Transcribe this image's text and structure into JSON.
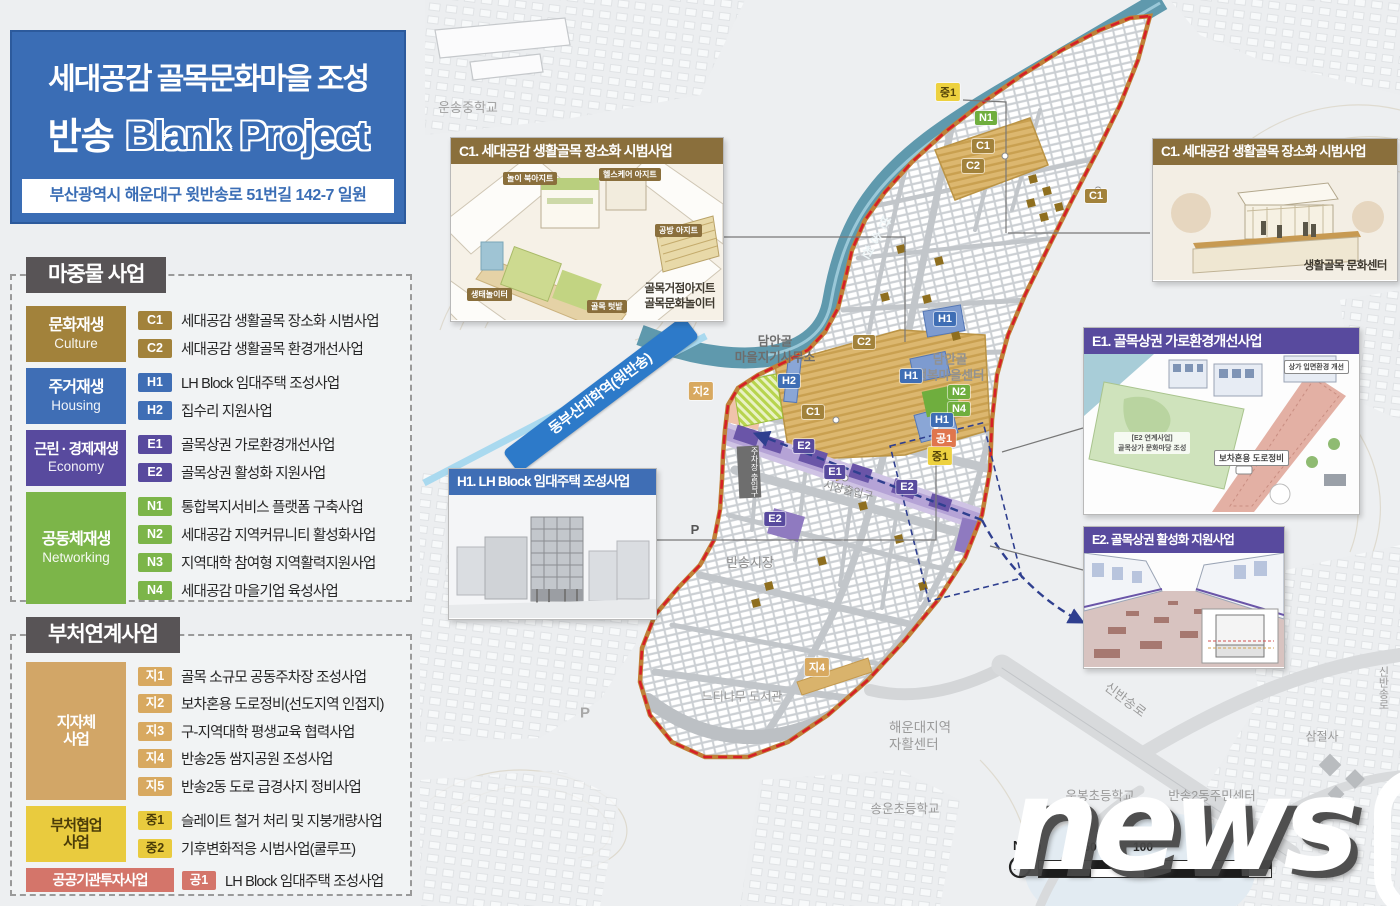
{
  "title_panel": {
    "line1": "세대공감 골목문화마을 조성",
    "line2_prefix": "반송",
    "line2_main": "Blank Project",
    "address": "부산광역시 해운대구 윗반송로 51번길 142-7 일원"
  },
  "legend_primary": {
    "header": "마중물 사업",
    "categories": [
      {
        "name": "문화재생",
        "en": "Culture",
        "color": "#a2823b",
        "items": [
          {
            "code": "C1",
            "label": "세대공감 생활골목 장소화 시범사업"
          },
          {
            "code": "C2",
            "label": "세대공감 생활골목 환경개선사업"
          }
        ]
      },
      {
        "name": "주거재생",
        "en": "Housing",
        "color": "#3f6eb5",
        "items": [
          {
            "code": "H1",
            "label": "LH Block 임대주택 조성사업"
          },
          {
            "code": "H2",
            "label": "집수리 지원사업"
          }
        ]
      },
      {
        "name": "근린 · 경제재생",
        "en": "Economy",
        "color": "#584a9e",
        "items": [
          {
            "code": "E1",
            "label": "골목상권 가로환경개선사업"
          },
          {
            "code": "E2",
            "label": "골목상권 활성화 지원사업"
          }
        ]
      },
      {
        "name": "공동체재생",
        "en": "Networking",
        "color": "#7cb549",
        "items": [
          {
            "code": "N1",
            "label": "통합복지서비스 플랫폼 구축사업"
          },
          {
            "code": "N2",
            "label": "세대공감 지역커뮤니티 활성화사업"
          },
          {
            "code": "N3",
            "label": "지역대학 참여형 지역활력지원사업"
          },
          {
            "code": "N4",
            "label": "세대공감 마을기업 육성사업"
          }
        ]
      }
    ]
  },
  "legend_secondary": {
    "header": "부처연계사업",
    "groups": [
      {
        "name": "지자체\n사업",
        "color": "#d2a667",
        "items": [
          {
            "code": "지1",
            "label": "골목 소규모 공동주차장 조성사업"
          },
          {
            "code": "지2",
            "label": "보차혼용 도로정비(선도지역 인접지)"
          },
          {
            "code": "지3",
            "label": "구-지역대학 평생교육 협력사업"
          },
          {
            "code": "지4",
            "label": "반송2동 쌈지공원 조성사업"
          },
          {
            "code": "지5",
            "label": "반송2동 도로 급경사지 정비사업"
          }
        ]
      },
      {
        "name": "부처협업\n사업",
        "color": "#e9cb3e",
        "items": [
          {
            "code": "중1",
            "label": "슬레이트 철거 처리 및 지붕개량사업"
          },
          {
            "code": "중2",
            "label": "기후변화적응 시범사업(쿨루프)"
          }
        ]
      },
      {
        "name": "공공기관투자사업",
        "color": "#d4756a",
        "items": [
          {
            "code": "공1",
            "label": "LH Block 임대주택 조성사업"
          }
        ]
      }
    ]
  },
  "map": {
    "station_banner": "동부산대학역(윗반송)",
    "labels": [
      {
        "text": "운송중학교"
      },
      {
        "text": "반송천"
      },
      {
        "text": "담안골\n마을지기사무소"
      },
      {
        "text": "담안골\n행복마을센터"
      },
      {
        "text": "주차장 출입구"
      },
      {
        "text": "시장출입구"
      },
      {
        "text": "반송시장"
      },
      {
        "text": "P"
      },
      {
        "text": "P"
      },
      {
        "text": "느티나무 도서관"
      },
      {
        "text": "해운대지역\n자활센터"
      },
      {
        "text": "송운초등학교"
      },
      {
        "text": "운봉초등학교"
      },
      {
        "text": "반송2동주민센터"
      },
      {
        "text": "신반송로"
      },
      {
        "text": "신반송로"
      },
      {
        "text": "삼절사"
      }
    ],
    "markers": [
      {
        "label": "중1"
      },
      {
        "label": "N1"
      },
      {
        "label": "C1"
      },
      {
        "label": "C2"
      },
      {
        "label": "C1"
      },
      {
        "label": "H1"
      },
      {
        "label": "C2"
      },
      {
        "label": "H1"
      },
      {
        "label": "H2"
      },
      {
        "label": "N2"
      },
      {
        "label": "N4"
      },
      {
        "label": "지2"
      },
      {
        "label": "C1"
      },
      {
        "label": "H1"
      },
      {
        "label": "공1"
      },
      {
        "label": "중1"
      },
      {
        "label": "E2"
      },
      {
        "label": "E1"
      },
      {
        "label": "E2"
      },
      {
        "label": "E2"
      },
      {
        "label": "지4"
      }
    ],
    "callouts": {
      "c1_left": {
        "title": "C1. 세대공감 생활골목 장소화 시범사업",
        "tags": [
          "놀이 북아지트",
          "헬스케어 아지트",
          "공방 아지트",
          "생태놀이터",
          "골목 텃밭"
        ],
        "caption": "골목거점아지트\n골목문화놀이터"
      },
      "c1_right": {
        "title": "C1. 세대공감 생활골목 장소화 시범사업",
        "caption": "생활골목 문화센터"
      },
      "e1": {
        "title": "E1. 골목상권 가로환경개선사업",
        "tags": [
          "상가 입면환경 개선",
          "[E2 연계사업]\n골목상가 문화마당 조성",
          "보차혼용 도로정비"
        ]
      },
      "e2": {
        "title": "E2. 골목상권 활성화 지원사업"
      },
      "h1": {
        "title": "H1. LH Block 임대주택 조성사업"
      }
    },
    "scalebar": {
      "north": "N",
      "ticks": [
        "0",
        "50",
        "100",
        "200"
      ]
    },
    "watermark": {
      "text": "news",
      "numeral": "1"
    }
  }
}
